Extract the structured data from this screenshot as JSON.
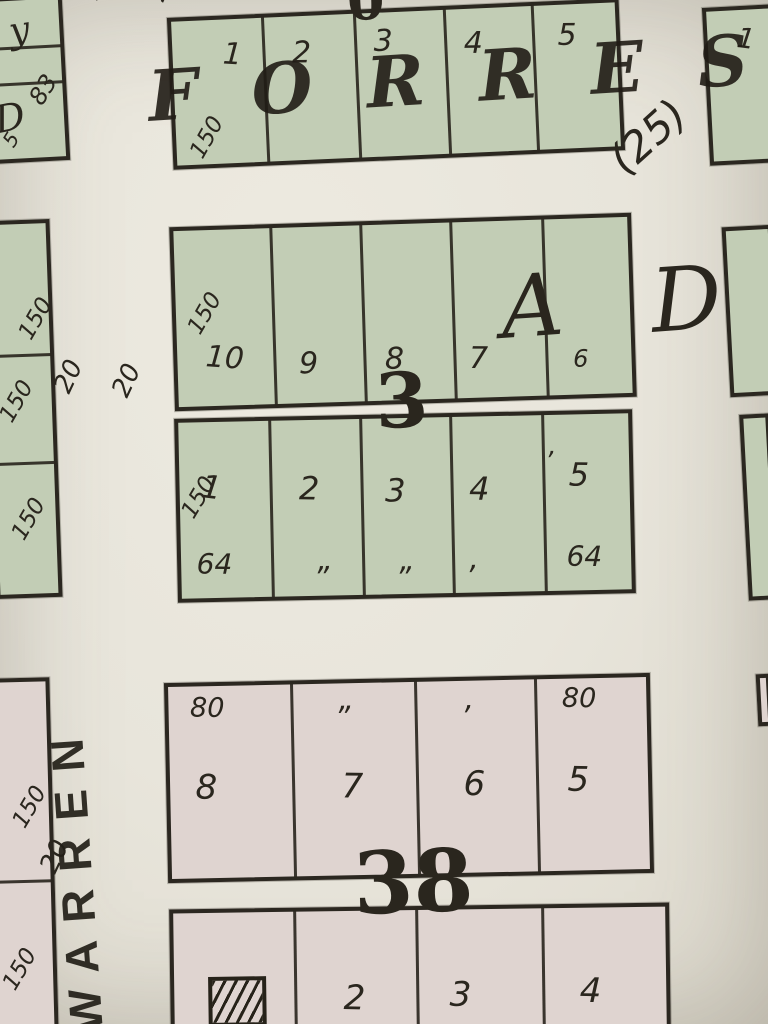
{
  "meta": {
    "description": "Photograph of a vintage plat map page showing numbered lots in blocks 3 and 38 along Forrest and Warren streets",
    "palette": {
      "paper": "#e8e5db",
      "green": "#c2cdb5",
      "pink": "#dfd4d0",
      "ink": "#2b2720"
    }
  },
  "streets": {
    "horizontal_name": "FORREST",
    "vertical_name": "WARREN",
    "addition_letters_partial": "A D",
    "parcel_annotation": "(25)"
  },
  "block_numbers": {
    "block3": "3",
    "block38": "38",
    "top_partial": "0"
  },
  "blocks": [
    {
      "id": "block-top-left",
      "name": "block-top-left",
      "fill": "green",
      "x": -10,
      "y": -4,
      "w": 76,
      "h": 166,
      "rot": -3,
      "hlines": [
        46,
        82
      ],
      "vlines": [],
      "texts": [
        {
          "t": "y",
          "x": 16,
          "y": 14,
          "fs": 36,
          "rot": -6,
          "style": "serif-italic",
          "name": "partial-letter"
        },
        {
          "t": "83",
          "x": 30,
          "y": 96,
          "fs": 24,
          "rot": -55,
          "name": "dimension-label"
        },
        {
          "t": "D",
          "x": -4,
          "y": 100,
          "fs": 38,
          "rot": -8,
          "style": "serif-italic",
          "name": "partial-letter"
        },
        {
          "t": "5",
          "x": 2,
          "y": 138,
          "fs": 20,
          "rot": -55,
          "name": "dimension-label"
        }
      ]
    },
    {
      "id": "block-forrest-row",
      "name": "block-forrest-row",
      "fill": "green",
      "x": 170,
      "y": 8,
      "w": 452,
      "h": 152,
      "rot": -2.5,
      "hlines": [],
      "vlines": [
        90,
        182,
        272,
        360
      ],
      "texts": [
        {
          "t": "1",
          "x": 52,
          "y": 20,
          "fs": 30,
          "rot": 6,
          "name": "lot-number"
        },
        {
          "t": "2",
          "x": 120,
          "y": 22,
          "fs": 30,
          "rot": 2,
          "name": "lot-number"
        },
        {
          "t": "3",
          "x": 202,
          "y": 14,
          "fs": 30,
          "rot": 2,
          "name": "lot-number"
        },
        {
          "t": "4",
          "x": 292,
          "y": 20,
          "fs": 30,
          "rot": 2,
          "name": "lot-number"
        },
        {
          "t": "5",
          "x": 386,
          "y": 16,
          "fs": 30,
          "rot": 2,
          "name": "lot-number"
        },
        {
          "t": "150",
          "x": 10,
          "y": 130,
          "fs": 23,
          "rot": -58,
          "name": "dimension-label"
        }
      ]
    },
    {
      "id": "lot-top-right",
      "name": "lot-top-right",
      "fill": "green",
      "x": 706,
      "y": 6,
      "w": 70,
      "h": 158,
      "rot": -3,
      "hlines": [],
      "vlines": [],
      "texts": [
        {
          "t": "1",
          "x": 32,
          "y": 14,
          "fs": 28,
          "rot": 10,
          "name": "lot-number"
        }
      ]
    },
    {
      "id": "block3-upper-row",
      "name": "block3-upper-row",
      "fill": "green",
      "x": 172,
      "y": 220,
      "w": 462,
      "h": 184,
      "rot": -1.8,
      "hlines": [],
      "vlines": [
        96,
        186,
        276,
        368
      ],
      "texts": [
        {
          "t": "10",
          "x": 30,
          "y": 112,
          "fs": 30,
          "rot": 6,
          "name": "lot-number"
        },
        {
          "t": "9",
          "x": 122,
          "y": 122,
          "fs": 30,
          "rot": 2,
          "name": "lot-number"
        },
        {
          "t": "8",
          "x": 208,
          "y": 120,
          "fs": 30,
          "rot": 2,
          "name": "lot-number"
        },
        {
          "t": "7",
          "x": 292,
          "y": 122,
          "fs": 30,
          "rot": 2,
          "name": "lot-number"
        },
        {
          "t": "6",
          "x": 396,
          "y": 128,
          "fs": 24,
          "rot": 2,
          "name": "lot-number"
        },
        {
          "t": "150",
          "x": 8,
          "y": 96,
          "fs": 23,
          "rot": -58,
          "name": "dimension-label"
        }
      ]
    },
    {
      "id": "block3-lower-row",
      "name": "block3-lower-row",
      "fill": "green",
      "x": 176,
      "y": 414,
      "w": 458,
      "h": 184,
      "rot": -1.2,
      "hlines": [],
      "vlines": [
        90,
        181,
        271,
        363
      ],
      "texts": [
        {
          "t": "1",
          "x": 24,
          "y": 48,
          "fs": 32,
          "rot": 8,
          "name": "lot-number"
        },
        {
          "t": "2",
          "x": 120,
          "y": 52,
          "fs": 32,
          "rot": 2,
          "name": "lot-number"
        },
        {
          "t": "3",
          "x": 206,
          "y": 56,
          "fs": 32,
          "rot": 2,
          "name": "lot-number"
        },
        {
          "t": "4",
          "x": 290,
          "y": 56,
          "fs": 32,
          "rot": 2,
          "name": "lot-number"
        },
        {
          "t": "5",
          "x": 390,
          "y": 44,
          "fs": 32,
          "rot": 2,
          "name": "lot-number"
        },
        {
          "t": "’",
          "x": 366,
          "y": 34,
          "fs": 26,
          "rot": 0,
          "name": "tick-mark"
        },
        {
          "t": "150",
          "x": -2,
          "y": 88,
          "fs": 23,
          "rot": -58,
          "name": "dimension-label"
        },
        {
          "t": "64",
          "x": 16,
          "y": 128,
          "fs": 28,
          "rot": 2,
          "name": "dimension-label"
        },
        {
          "t": "„",
          "x": 136,
          "y": 126,
          "fs": 30,
          "rot": 0,
          "name": "ditto-mark"
        },
        {
          "t": "„",
          "x": 218,
          "y": 128,
          "fs": 30,
          "rot": 0,
          "name": "ditto-mark"
        },
        {
          "t": "‚",
          "x": 288,
          "y": 128,
          "fs": 30,
          "rot": 0,
          "name": "ditto-mark"
        },
        {
          "t": "64",
          "x": 386,
          "y": 128,
          "fs": 28,
          "rot": 2,
          "name": "dimension-label"
        }
      ]
    },
    {
      "id": "left-strip-green",
      "name": "left-strip-green",
      "fill": "green",
      "x": -10,
      "y": 220,
      "w": 66,
      "h": 378,
      "rot": -2,
      "hlines": [
        130,
        238
      ],
      "vlines": [],
      "texts": [
        {
          "t": "150",
          "x": 24,
          "y": 108,
          "fs": 23,
          "rot": -58,
          "name": "dimension-label"
        },
        {
          "t": "150",
          "x": 2,
          "y": 190,
          "fs": 23,
          "rot": -58,
          "name": "dimension-label"
        },
        {
          "t": "150",
          "x": 10,
          "y": 308,
          "fs": 23,
          "rot": -58,
          "name": "dimension-label"
        }
      ]
    },
    {
      "id": "right-strip-upper",
      "name": "right-strip-upper",
      "fill": "green",
      "x": 726,
      "y": 226,
      "w": 50,
      "h": 170,
      "rot": -3,
      "hlines": [],
      "vlines": [],
      "texts": []
    },
    {
      "id": "right-strip-lower",
      "name": "right-strip-lower",
      "fill": "green",
      "x": 744,
      "y": 414,
      "w": 30,
      "h": 186,
      "rot": -3,
      "hlines": [],
      "vlines": [],
      "texts": []
    },
    {
      "id": "right-corner-pink",
      "name": "right-corner-pink",
      "fill": "pink",
      "x": 757,
      "y": 674,
      "w": 14,
      "h": 52,
      "rot": -3,
      "hlines": [],
      "vlines": [],
      "texts": []
    },
    {
      "id": "block38-upper-row",
      "name": "block38-upper-row",
      "fill": "pink",
      "x": 166,
      "y": 678,
      "w": 486,
      "h": 200,
      "rot": -1.2,
      "hlines": [],
      "vlines": [
        122,
        246,
        366
      ],
      "texts": [
        {
          "t": "80",
          "x": 22,
          "y": 8,
          "fs": 27,
          "rot": 2,
          "name": "dimension-label"
        },
        {
          "t": "„",
          "x": 170,
          "y": 2,
          "fs": 30,
          "rot": 0,
          "name": "ditto-mark"
        },
        {
          "t": "‚",
          "x": 296,
          "y": 4,
          "fs": 30,
          "rot": 0,
          "name": "ditto-mark"
        },
        {
          "t": "80",
          "x": 394,
          "y": 6,
          "fs": 27,
          "rot": 2,
          "name": "dimension-label"
        },
        {
          "t": "8",
          "x": 26,
          "y": 84,
          "fs": 34,
          "rot": 2,
          "name": "lot-number"
        },
        {
          "t": "7",
          "x": 172,
          "y": 86,
          "fs": 34,
          "rot": 2,
          "name": "lot-number"
        },
        {
          "t": "6",
          "x": 294,
          "y": 86,
          "fs": 34,
          "rot": 2,
          "name": "lot-number"
        },
        {
          "t": "5",
          "x": 398,
          "y": 84,
          "fs": 34,
          "rot": 2,
          "name": "lot-number"
        }
      ]
    },
    {
      "id": "block38-lower-row",
      "name": "block38-lower-row",
      "fill": "pink",
      "x": 170,
      "y": 906,
      "w": 500,
      "h": 130,
      "rot": -0.8,
      "hlines": [],
      "vlines": [
        120,
        242,
        368
      ],
      "texts": [
        {
          "t": "2",
          "x": 170,
          "y": 70,
          "fs": 34,
          "rot": 2,
          "name": "lot-number"
        },
        {
          "t": "3",
          "x": 276,
          "y": 68,
          "fs": 34,
          "rot": 2,
          "name": "lot-number"
        },
        {
          "t": "4",
          "x": 406,
          "y": 66,
          "fs": 34,
          "rot": 2,
          "name": "lot-number"
        }
      ],
      "hatch": {
        "x": 34,
        "y": 64,
        "w": 58,
        "h": 50,
        "name": "hatched-building-icon"
      }
    },
    {
      "id": "left-strip-pink",
      "name": "left-strip-pink",
      "fill": "pink",
      "x": -10,
      "y": 678,
      "w": 64,
      "h": 356,
      "rot": -1.5,
      "hlines": [
        198
      ],
      "vlines": [],
      "texts": [
        {
          "t": "150",
          "x": 16,
          "y": 138,
          "fs": 23,
          "rot": -58,
          "name": "dimension-label"
        },
        {
          "t": "150",
          "x": 2,
          "y": 300,
          "fs": 23,
          "rot": -58,
          "name": "dimension-label"
        }
      ]
    }
  ],
  "floating_texts": [
    {
      "t": "FORREST",
      "x": 146,
      "y": 62,
      "fs": 70,
      "rot": -3.5,
      "style": "serif-italic street",
      "name": "street-name-forrest"
    },
    {
      "t": "(25)",
      "x": 602,
      "y": 150,
      "fs": 42,
      "rot": -42,
      "name": "survey-number-25"
    },
    {
      "t": "0",
      "x": 346,
      "y": -26,
      "fs": 54,
      "rot": -2,
      "style": "serif-bold",
      "name": "block-number-partial"
    },
    {
      "t": "2",
      "x": 78,
      "y": -8,
      "fs": 26,
      "rot": -65,
      "name": "dimension-label"
    },
    {
      "t": "2",
      "x": 144,
      "y": -6,
      "fs": 26,
      "rot": -65,
      "name": "dimension-label"
    },
    {
      "t": "A",
      "x": 498,
      "y": 266,
      "fs": 86,
      "rot": -4,
      "style": "serif-italic",
      "name": "addition-letter-a"
    },
    {
      "t": "D",
      "x": 648,
      "y": 258,
      "fs": 88,
      "rot": -4,
      "style": "serif-italic",
      "name": "addition-letter-d"
    },
    {
      "t": "3",
      "x": 374,
      "y": 364,
      "fs": 76,
      "rot": -2,
      "style": "serif-bold",
      "name": "block-number-3"
    },
    {
      "t": "38",
      "x": 352,
      "y": 842,
      "fs": 86,
      "rot": -2,
      "style": "serif-bold",
      "name": "block-number-38"
    },
    {
      "t": "20",
      "x": 50,
      "y": 386,
      "fs": 26,
      "rot": -65,
      "name": "street-width-label"
    },
    {
      "t": "20",
      "x": 108,
      "y": 390,
      "fs": 26,
      "rot": -65,
      "name": "street-width-label"
    },
    {
      "t": "20",
      "x": 36,
      "y": 866,
      "fs": 26,
      "rot": -65,
      "name": "street-width-label"
    },
    {
      "t": "WARREN",
      "x": 64,
      "y": 1034,
      "fs": 46,
      "rot": -94,
      "style": "warren",
      "name": "street-name-warren"
    }
  ]
}
